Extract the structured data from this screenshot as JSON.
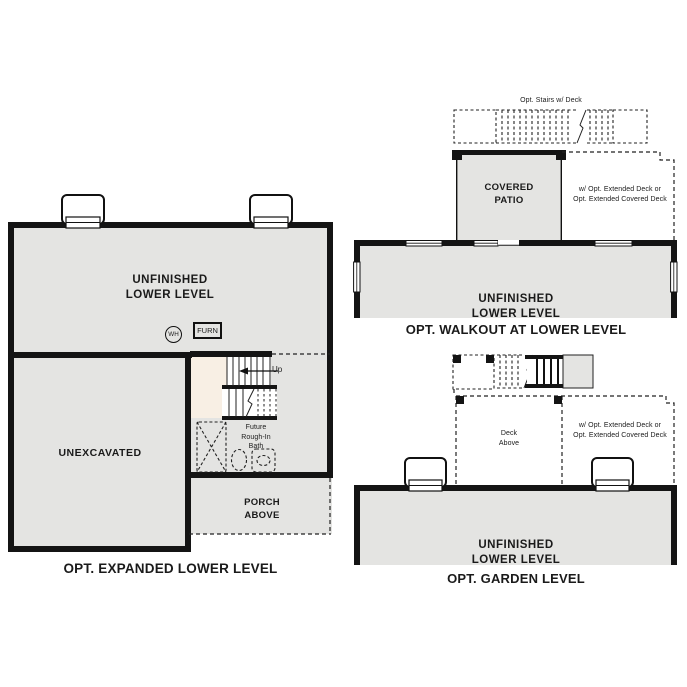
{
  "document_type": "floor-plan-options-sheet",
  "colors": {
    "wall": "#141414",
    "interior_fill": "#e4e4e2",
    "stair_landing_fill": "#f8efe4",
    "background": "#ffffff",
    "text": "#1a1a1a"
  },
  "plans": {
    "expanded": {
      "title": "OPT. EXPANDED LOWER LEVEL",
      "labels": {
        "room": "UNFINISHED\nLOWER LEVEL",
        "unexcavated": "UNEXCAVATED",
        "water_heater": "WH",
        "furnace": "FURN",
        "up": "Up",
        "future_bath": "Future\nRough-In\nBath",
        "porch": "PORCH\nABOVE"
      }
    },
    "walkout": {
      "title": "OPT. WALKOUT AT LOWER LEVEL",
      "labels": {
        "opt_stairs": "Opt. Stairs w/ Deck",
        "patio": "COVERED\nPATIO",
        "ext_deck": "w/ Opt. Extended Deck or\nOpt. Extended Covered Deck",
        "room": "UNFINISHED\nLOWER LEVEL"
      }
    },
    "garden": {
      "title": "OPT. GARDEN LEVEL",
      "labels": {
        "deck_above": "Deck\nAbove",
        "ext_deck": "w/ Opt. Extended Deck or\nOpt. Extended Covered Deck",
        "room": "UNFINISHED\nLOWER LEVEL"
      }
    }
  }
}
